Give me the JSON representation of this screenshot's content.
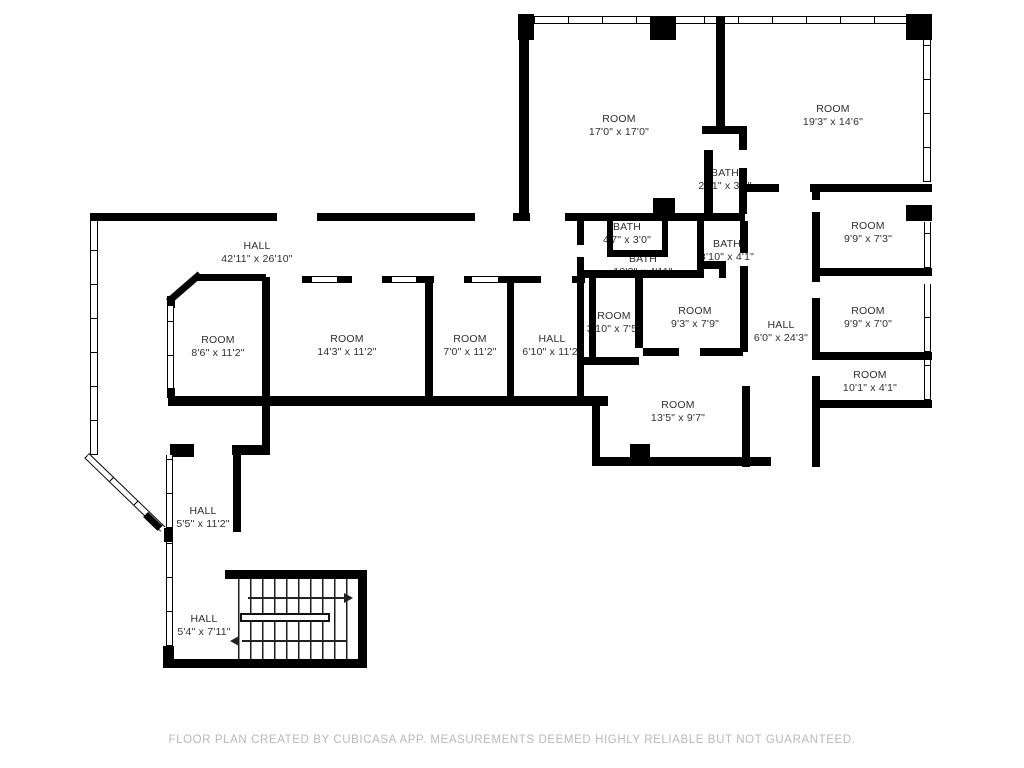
{
  "plan": {
    "footer": "FLOOR PLAN CREATED BY CUBICASA APP. MEASUREMENTS DEEMED HIGHLY RELIABLE BUT NOT GUARANTEED.",
    "colors": {
      "wall": "#000000",
      "label_text": "#2f2f2f",
      "footer_text": "#b9b9b9",
      "background": "#ffffff"
    },
    "rooms": [
      {
        "name": "ROOM",
        "dims": "17'0\" x 17'0\""
      },
      {
        "name": "ROOM",
        "dims": "19'3\" x 14'6\""
      },
      {
        "name": "BATH",
        "dims": "2'11\" x 3'8\""
      },
      {
        "name": "BATH",
        "dims": "4'7\" x 3'0\""
      },
      {
        "name": "BATH",
        "dims": "10'3\" x 4'11\""
      },
      {
        "name": "BATH",
        "dims": "3'10\" x 4'1\""
      },
      {
        "name": "ROOM",
        "dims": "3'10\" x 7'5\""
      },
      {
        "name": "ROOM",
        "dims": "9'3\" x 7'9\""
      },
      {
        "name": "HALL",
        "dims": "6'0\" x 24'3\""
      },
      {
        "name": "ROOM",
        "dims": "13'5\" x 9'7\""
      },
      {
        "name": "HALL",
        "dims": "42'11\" x 26'10\""
      },
      {
        "name": "ROOM",
        "dims": "8'6\" x 11'2\""
      },
      {
        "name": "ROOM",
        "dims": "14'3\" x 11'2\""
      },
      {
        "name": "ROOM",
        "dims": "7'0\" x 11'2\""
      },
      {
        "name": "HALL",
        "dims": "6'10\" x 11'2\""
      },
      {
        "name": "ROOM",
        "dims": "9'9\" x 7'3\""
      },
      {
        "name": "ROOM",
        "dims": "9'9\" x 7'0\""
      },
      {
        "name": "ROOM",
        "dims": "10'1\" x 4'1\""
      },
      {
        "name": "HALL",
        "dims": "5'5\" x 11'2\""
      },
      {
        "name": "HALL",
        "dims": "5'4\" x 7'11\""
      }
    ]
  }
}
